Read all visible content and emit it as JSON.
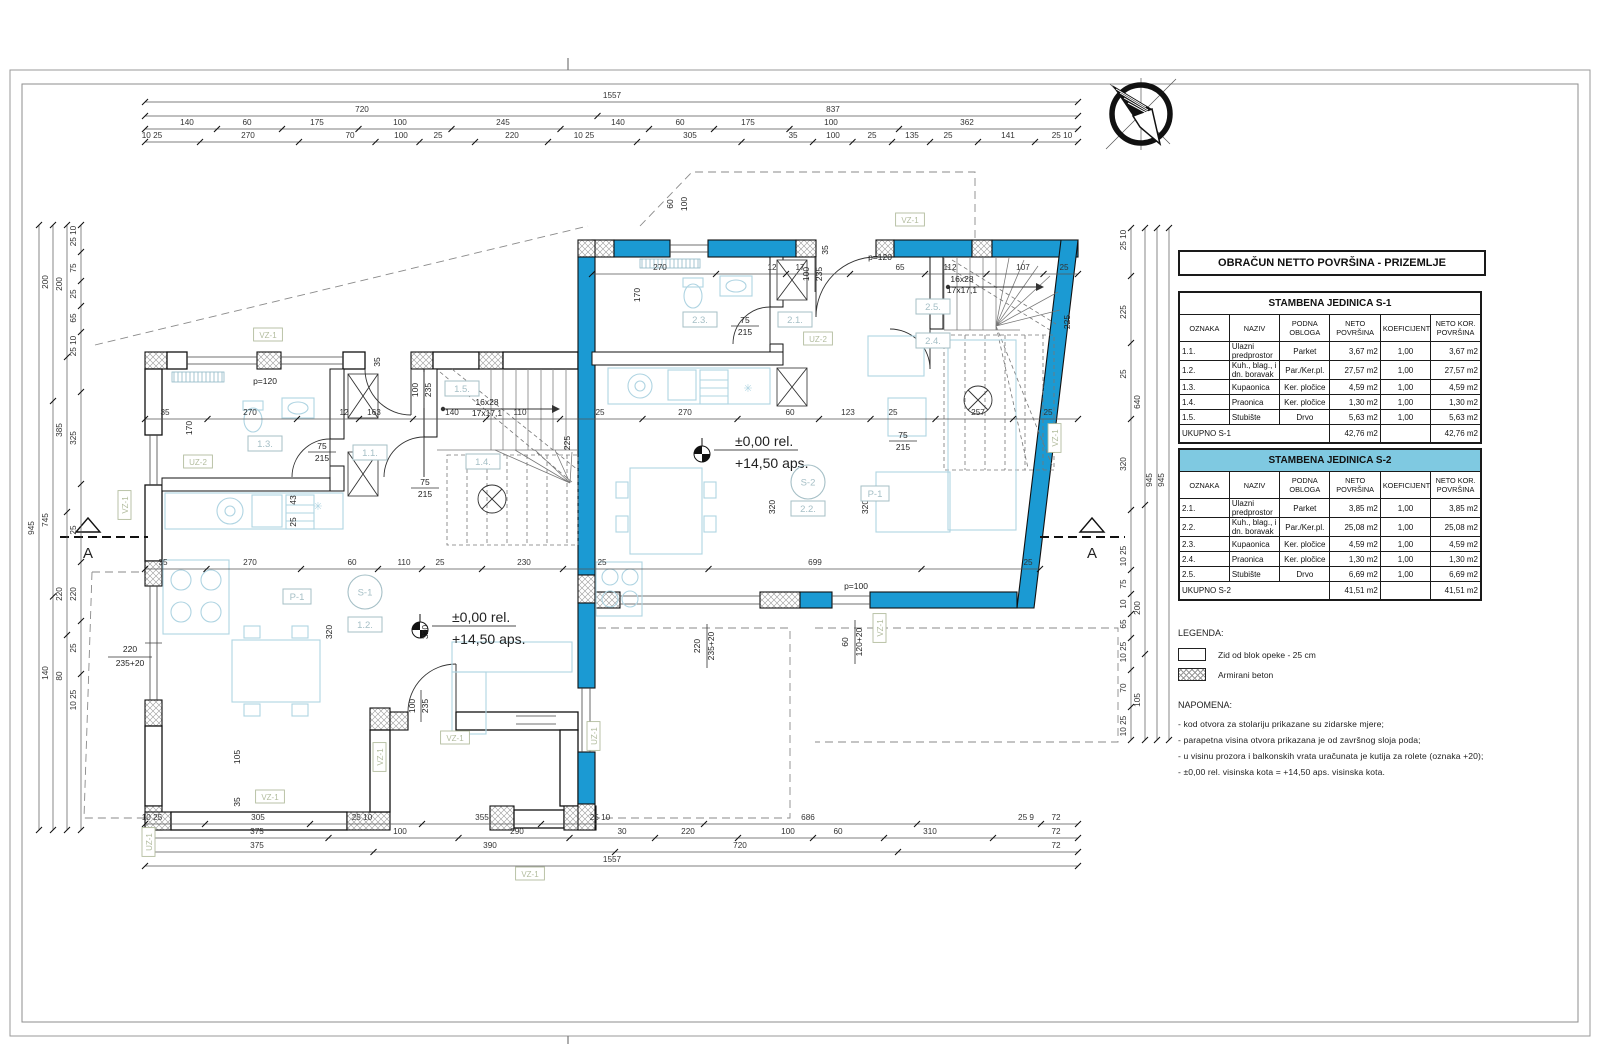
{
  "panel": {
    "title": "OBRAČUN NETTO POVRŠINA - PRIZEMLJE",
    "tables": [
      {
        "title": "STAMBENA JEDINICA S-1",
        "header_bg": "#FFFFFF",
        "columns": [
          "OZNAKA",
          "NAZIV",
          "PODNA\nOBLOGA",
          "NETO\nPOVRŠINA",
          "KOEFICIJENT",
          "NETO KOR.\nPOVRŠINA"
        ],
        "rows": [
          [
            "1.1.",
            "Ulazni predprostor",
            "Parket",
            "3,67 m2",
            "1,00",
            "3,67 m2"
          ],
          [
            "1.2.",
            "Kuh., blag., i dn. boravak",
            "Par./Ker.pl.",
            "27,57 m2",
            "1,00",
            "27,57 m2"
          ],
          [
            "1.3.",
            "Kupaonica",
            "Ker. pločice",
            "4,59 m2",
            "1,00",
            "4,59 m2"
          ],
          [
            "1.4.",
            "Praonica",
            "Ker. pločice",
            "1,30 m2",
            "1,00",
            "1,30 m2"
          ],
          [
            "1.5.",
            "Stubište",
            "Drvo",
            "5,63 m2",
            "1,00",
            "5,63 m2"
          ]
        ],
        "total": {
          "label": "UKUPNO S-1",
          "neto": "42,76 m2",
          "kor": "42,76 m2"
        }
      },
      {
        "title": "STAMBENA JEDINICA S-2",
        "header_bg": "#7FC9E1",
        "columns": [
          "OZNAKA",
          "NAZIV",
          "PODNA\nOBLOGA",
          "NETO\nPOVRŠINA",
          "KOEFICIJENT",
          "NETO KOR.\nPOVRŠINA"
        ],
        "rows": [
          [
            "2.1.",
            "Ulazni predprostor",
            "Parket",
            "3,85 m2",
            "1,00",
            "3,85 m2"
          ],
          [
            "2.2.",
            "Kuh., blag., i dn. boravak",
            "Par./Ker.pl.",
            "25,08 m2",
            "1,00",
            "25,08 m2"
          ],
          [
            "2.3.",
            "Kupaonica",
            "Ker. pločice",
            "4,59 m2",
            "1,00",
            "4,59 m2"
          ],
          [
            "2.4.",
            "Praonica",
            "Ker. pločice",
            "1,30 m2",
            "1,00",
            "1,30 m2"
          ],
          [
            "2.5.",
            "Stubište",
            "Drvo",
            "6,69 m2",
            "1,00",
            "6,69 m2"
          ]
        ],
        "total": {
          "label": "UKUPNO S-2",
          "neto": "41,51 m2",
          "kor": "41,51 m2"
        }
      }
    ],
    "legend": {
      "title": "LEGENDA:",
      "items": [
        {
          "name": "brick-wall-swatch",
          "label": "Zid od blok opeke - 25 cm"
        },
        {
          "name": "concrete-swatch",
          "label": "Armirani beton"
        }
      ]
    },
    "notes": {
      "title": "NAPOMENA:",
      "items": [
        "-  kod otvora za stolariju prikazane su zidarske mjere;",
        "-  parapetna visina otvora prikazana je od završnog sloja poda;",
        "-  u visinu prozora i balkonskih vrata uračunata je kutija za rolete (oznaka +20);",
        "-  ±0,00 rel. visinska kota  =  +14,50 aps. visinska kota."
      ]
    }
  },
  "plan": {
    "colors": {
      "wall_blue": "#1B9AD3",
      "table_header_blue": "#7FC9E1",
      "furniture": "#AFD4E2",
      "tag": "#B2BC9E",
      "room": "#A5BFC6"
    },
    "dim_rows_h": [
      {
        "y": 98,
        "x1": 145,
        "x2": 1078,
        "L": [
          {
            "x": 612,
            "t": "1557"
          }
        ]
      },
      {
        "y": 112,
        "x1": 145,
        "x2": 1078,
        "L": [
          {
            "x": 362,
            "t": "720"
          },
          {
            "x": 833,
            "t": "837"
          }
        ]
      },
      {
        "y": 125,
        "x1": 145,
        "x2": 1078,
        "L": [
          {
            "x": 187,
            "t": "140"
          },
          {
            "x": 247,
            "t": "60"
          },
          {
            "x": 317,
            "t": "175"
          },
          {
            "x": 400,
            "t": "100"
          },
          {
            "x": 503,
            "t": "245"
          },
          {
            "x": 618,
            "t": "140"
          },
          {
            "x": 680,
            "t": "60"
          },
          {
            "x": 748,
            "t": "175"
          },
          {
            "x": 831,
            "t": "100"
          },
          {
            "x": 967,
            "t": "362"
          }
        ]
      },
      {
        "y": 138,
        "x1": 145,
        "x2": 1078,
        "L": [
          {
            "x": 152,
            "t": "10 25"
          },
          {
            "x": 248,
            "t": "270"
          },
          {
            "x": 350,
            "t": "70"
          },
          {
            "x": 401,
            "t": "100"
          },
          {
            "x": 438,
            "t": "25"
          },
          {
            "x": 512,
            "t": "220"
          },
          {
            "x": 584,
            "t": "10 25"
          },
          {
            "x": 690,
            "t": "305"
          },
          {
            "x": 793,
            "t": "35"
          },
          {
            "x": 833,
            "t": "100"
          },
          {
            "x": 872,
            "t": "25"
          },
          {
            "x": 912,
            "t": "135"
          },
          {
            "x": 948,
            "t": "25"
          },
          {
            "x": 1008,
            "t": "141"
          },
          {
            "x": 1062,
            "t": "25 10"
          }
        ]
      },
      {
        "y": 270,
        "x1": 592,
        "x2": 1078,
        "L": [
          {
            "x": 660,
            "t": "270"
          },
          {
            "x": 772,
            "t": "12"
          },
          {
            "x": 800,
            "t": "17"
          },
          {
            "x": 900,
            "t": "65"
          },
          {
            "x": 950,
            "t": "112"
          },
          {
            "x": 1023,
            "t": "107"
          },
          {
            "x": 1064,
            "t": "25"
          }
        ]
      },
      {
        "y": 415,
        "x1": 145,
        "x2": 1078,
        "L": [
          {
            "x": 165,
            "t": "35"
          },
          {
            "x": 250,
            "t": "270"
          },
          {
            "x": 344,
            "t": "12"
          },
          {
            "x": 374,
            "t": "163"
          },
          {
            "x": 452,
            "t": "140"
          },
          {
            "x": 520,
            "t": "110"
          },
          {
            "x": 600,
            "t": "25"
          },
          {
            "x": 685,
            "t": "270"
          },
          {
            "x": 790,
            "t": "60"
          },
          {
            "x": 848,
            "t": "123"
          },
          {
            "x": 893,
            "t": "25"
          },
          {
            "x": 978,
            "t": "257"
          },
          {
            "x": 1048,
            "t": "25"
          }
        ]
      },
      {
        "y": 565,
        "x1": 145,
        "x2": 1040,
        "L": [
          {
            "x": 163,
            "t": "35"
          },
          {
            "x": 250,
            "t": "270"
          },
          {
            "x": 352,
            "t": "60"
          },
          {
            "x": 404,
            "t": "110"
          },
          {
            "x": 440,
            "t": "25"
          },
          {
            "x": 524,
            "t": "230"
          },
          {
            "x": 602,
            "t": "25"
          },
          {
            "x": 815,
            "t": "699"
          },
          {
            "x": 1028,
            "t": "25"
          }
        ]
      },
      {
        "y": 820,
        "x1": 145,
        "x2": 1078,
        "L": [
          {
            "x": 152,
            "t": "10 25"
          },
          {
            "x": 258,
            "t": "305"
          },
          {
            "x": 362,
            "t": "25 10"
          },
          {
            "x": 482,
            "t": "355"
          },
          {
            "x": 600,
            "t": "25 10"
          },
          {
            "x": 808,
            "t": "686"
          },
          {
            "x": 1026,
            "t": "25 9"
          },
          {
            "x": 1056,
            "t": "72"
          }
        ]
      },
      {
        "y": 834,
        "x1": 145,
        "x2": 1078,
        "L": [
          {
            "x": 257,
            "t": "375"
          },
          {
            "x": 400,
            "t": "100"
          },
          {
            "x": 517,
            "t": "290"
          },
          {
            "x": 622,
            "t": "30"
          },
          {
            "x": 688,
            "t": "220"
          },
          {
            "x": 788,
            "t": "100"
          },
          {
            "x": 838,
            "t": "60"
          },
          {
            "x": 930,
            "t": "310"
          },
          {
            "x": 1056,
            "t": "72"
          }
        ]
      },
      {
        "y": 848,
        "x1": 145,
        "x2": 1078,
        "L": [
          {
            "x": 257,
            "t": "375"
          },
          {
            "x": 490,
            "t": "390"
          },
          {
            "x": 740,
            "t": "720"
          },
          {
            "x": 1056,
            "t": "72"
          }
        ]
      },
      {
        "y": 862,
        "x1": 145,
        "x2": 1078,
        "L": [
          {
            "x": 612,
            "t": "1557"
          }
        ]
      }
    ],
    "dim_cols_v": [
      {
        "x": 34,
        "y1": 225,
        "y2": 830,
        "L": [
          {
            "y": 528,
            "t": "945"
          }
        ]
      },
      {
        "x": 48,
        "y1": 225,
        "y2": 830,
        "L": [
          {
            "y": 282,
            "t": "200"
          },
          {
            "y": 520,
            "t": "745"
          },
          {
            "y": 673,
            "t": "140"
          }
        ]
      },
      {
        "x": 62,
        "y1": 225,
        "y2": 830,
        "L": [
          {
            "y": 284,
            "t": "200"
          },
          {
            "y": 430,
            "t": "385"
          },
          {
            "y": 594,
            "t": "220"
          },
          {
            "y": 676,
            "t": "80"
          }
        ]
      },
      {
        "x": 76,
        "y1": 225,
        "y2": 830,
        "L": [
          {
            "y": 236,
            "t": "25 10"
          },
          {
            "y": 268,
            "t": "75"
          },
          {
            "y": 294,
            "t": "25"
          },
          {
            "y": 318,
            "t": "65"
          },
          {
            "y": 346,
            "t": "25 10"
          },
          {
            "y": 438,
            "t": "325"
          },
          {
            "y": 530,
            "t": "25"
          },
          {
            "y": 594,
            "t": "220"
          },
          {
            "y": 648,
            "t": "25"
          },
          {
            "y": 700,
            "t": "10 25"
          }
        ]
      },
      {
        "x": 1126,
        "y1": 228,
        "y2": 740,
        "L": [
          {
            "y": 240,
            "t": "25 10"
          },
          {
            "y": 312,
            "t": "225"
          },
          {
            "y": 374,
            "t": "25"
          },
          {
            "y": 464,
            "t": "320"
          },
          {
            "y": 556,
            "t": "10 25"
          },
          {
            "y": 584,
            "t": "75"
          },
          {
            "y": 604,
            "t": "10"
          },
          {
            "y": 624,
            "t": "65"
          },
          {
            "y": 652,
            "t": "10 25"
          },
          {
            "y": 688,
            "t": "70"
          },
          {
            "y": 726,
            "t": "10 25"
          }
        ]
      },
      {
        "x": 1140,
        "y1": 228,
        "y2": 740,
        "L": [
          {
            "y": 402,
            "t": "640"
          },
          {
            "y": 608,
            "t": "200"
          },
          {
            "y": 700,
            "t": "105"
          }
        ]
      },
      {
        "x": 1152,
        "y1": 228,
        "y2": 740,
        "L": [
          {
            "y": 480,
            "t": "945"
          }
        ]
      },
      {
        "x": 1164,
        "y1": 228,
        "y2": 740,
        "L": [
          {
            "y": 480,
            "t": "945"
          }
        ]
      }
    ],
    "texts": [
      {
        "x": 487,
        "y": 405,
        "t": "16x28"
      },
      {
        "x": 487,
        "y": 416,
        "t": "17x17,1"
      },
      {
        "x": 962,
        "y": 282,
        "t": "16x28"
      },
      {
        "x": 962,
        "y": 293,
        "t": "17x17,1"
      },
      {
        "x": 265,
        "y": 384,
        "t": "p=120"
      },
      {
        "x": 880,
        "y": 260,
        "t": "p=120"
      },
      {
        "x": 856,
        "y": 589,
        "t": "p=100"
      },
      {
        "x": 452,
        "y": 622,
        "t": "±0,00  rel.",
        "fs": 14,
        "a": "start"
      },
      {
        "x": 452,
        "y": 644,
        "t": "+14,50  aps.",
        "fs": 14,
        "a": "start"
      },
      {
        "x": 735,
        "y": 446,
        "t": "±0,00  rel.",
        "fs": 14,
        "a": "start"
      },
      {
        "x": 735,
        "y": 468,
        "t": "+14,50  aps.",
        "fs": 14,
        "a": "start"
      },
      {
        "x": 322,
        "y": 449,
        "t": "75"
      },
      {
        "x": 322,
        "y": 461,
        "t": "215"
      },
      {
        "x": 425,
        "y": 485,
        "t": "75"
      },
      {
        "x": 425,
        "y": 497,
        "t": "215"
      },
      {
        "x": 745,
        "y": 323,
        "t": "75"
      },
      {
        "x": 745,
        "y": 335,
        "t": "215"
      },
      {
        "x": 903,
        "y": 438,
        "t": "75"
      },
      {
        "x": 903,
        "y": 450,
        "t": "215"
      },
      {
        "x": 130,
        "y": 652,
        "t": "220"
      },
      {
        "x": 130,
        "y": 666,
        "t": "235+20"
      },
      {
        "x": 700,
        "y": 646,
        "t": "220",
        "r": 1
      },
      {
        "x": 714,
        "y": 646,
        "t": "235+20",
        "r": 1
      },
      {
        "x": 848,
        "y": 642,
        "t": "60",
        "r": 1
      },
      {
        "x": 862,
        "y": 642,
        "t": "120+20",
        "r": 1
      },
      {
        "x": 418,
        "y": 390,
        "t": "100",
        "r": 1
      },
      {
        "x": 431,
        "y": 390,
        "t": "235",
        "r": 1
      },
      {
        "x": 809,
        "y": 274,
        "t": "100",
        "r": 1
      },
      {
        "x": 822,
        "y": 274,
        "t": "235",
        "r": 1
      },
      {
        "x": 415,
        "y": 706,
        "t": "100",
        "r": 1
      },
      {
        "x": 428,
        "y": 706,
        "t": "235",
        "r": 1
      },
      {
        "x": 673,
        "y": 204,
        "t": "60",
        "r": 1
      },
      {
        "x": 687,
        "y": 204,
        "t": "100",
        "r": 1
      },
      {
        "x": 192,
        "y": 428,
        "t": "170",
        "r": 1
      },
      {
        "x": 640,
        "y": 295,
        "t": "170",
        "r": 1
      },
      {
        "x": 296,
        "y": 500,
        "t": "43",
        "r": 1
      },
      {
        "x": 296,
        "y": 522,
        "t": "25",
        "r": 1
      },
      {
        "x": 332,
        "y": 632,
        "t": "320",
        "r": 1
      },
      {
        "x": 428,
        "y": 632,
        "t": "320",
        "r": 1
      },
      {
        "x": 775,
        "y": 507,
        "t": "320",
        "r": 1
      },
      {
        "x": 868,
        "y": 507,
        "t": "320",
        "r": 1
      },
      {
        "x": 240,
        "y": 757,
        "t": "105",
        "r": 1
      },
      {
        "x": 240,
        "y": 802,
        "t": "35",
        "r": 1
      },
      {
        "x": 570,
        "y": 443,
        "t": "225",
        "r": 1
      },
      {
        "x": 1070,
        "y": 322,
        "t": "225",
        "r": 1
      },
      {
        "x": 828,
        "y": 250,
        "t": "35",
        "r": 1
      },
      {
        "x": 380,
        "y": 362,
        "t": "35",
        "r": 1
      },
      {
        "x": 318,
        "y": 510,
        "t": "✳",
        "fs": 11,
        "c": 1
      },
      {
        "x": 748,
        "y": 392,
        "t": "✳",
        "fs": 11,
        "c": 1
      },
      {
        "x": 88,
        "y": 558,
        "t": "A",
        "fs": 15
      },
      {
        "x": 1092,
        "y": 558,
        "t": "A",
        "fs": 15
      }
    ],
    "tags": [
      {
        "x": 268,
        "y": 338,
        "t": "VZ-1"
      },
      {
        "x": 910,
        "y": 223,
        "t": "VZ-1"
      },
      {
        "x": 455,
        "y": 741,
        "t": "VZ-1"
      },
      {
        "x": 530,
        "y": 877,
        "t": "VZ-1"
      },
      {
        "x": 270,
        "y": 800,
        "t": "VZ-1"
      },
      {
        "x": 128,
        "y": 505,
        "t": "VZ-1",
        "r": 1
      },
      {
        "x": 383,
        "y": 757,
        "t": "VZ-1",
        "r": 1
      },
      {
        "x": 1058,
        "y": 438,
        "t": "VZ-1",
        "r": 1
      },
      {
        "x": 883,
        "y": 628,
        "t": "VZ-1",
        "r": 1
      },
      {
        "x": 198,
        "y": 465,
        "t": "UZ-2"
      },
      {
        "x": 818,
        "y": 342,
        "t": "UZ-2"
      },
      {
        "x": 597,
        "y": 736,
        "t": "UZ-1",
        "r": 1
      },
      {
        "x": 152,
        "y": 842,
        "t": "UZ-1",
        "r": 1
      }
    ],
    "rooms": [
      {
        "x": 265,
        "y": 447,
        "t": "1.3."
      },
      {
        "x": 370,
        "y": 456,
        "t": "1.1."
      },
      {
        "x": 462,
        "y": 392,
        "t": "1.5."
      },
      {
        "x": 483,
        "y": 465,
        "t": "1.4."
      },
      {
        "x": 365,
        "y": 628,
        "t": "1.2."
      },
      {
        "x": 297,
        "y": 600,
        "t": "P-1"
      },
      {
        "x": 700,
        "y": 323,
        "t": "2.3."
      },
      {
        "x": 795,
        "y": 323,
        "t": "2.1."
      },
      {
        "x": 933,
        "y": 310,
        "t": "2.5."
      },
      {
        "x": 933,
        "y": 344,
        "t": "2.4."
      },
      {
        "x": 808,
        "y": 512,
        "t": "2.2."
      },
      {
        "x": 875,
        "y": 497,
        "t": "P-1"
      }
    ],
    "circles": [
      {
        "x": 365,
        "y": 592,
        "t": "S-1"
      },
      {
        "x": 808,
        "y": 482,
        "t": "S-2"
      }
    ],
    "section_label": "A"
  }
}
